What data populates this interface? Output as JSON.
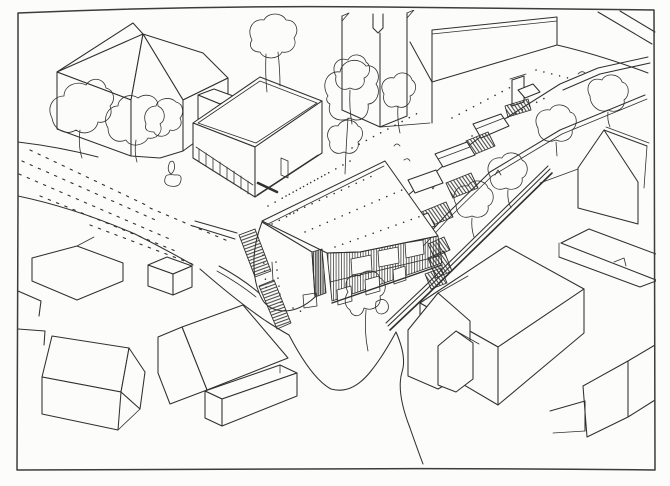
{
  "canvas": {
    "width": 670,
    "height": 486,
    "description": "Hand-drawn black ink architectural site sketch, aerial axonometric view of a village centre: a proposed timber-clad community building with a large mono-pitch roof sits at the junction of two streets, reached by terraced landscaped steps beside a church tower and churchyard wall; surrounding gabled houses, a flat-roofed hall, trees and roads frame the scene inside a hand-drawn border."
  },
  "css_vars": {
    "--paper": "#fcfcfa",
    "--ink": "#303030",
    "--border-ink": "#3c3c3c"
  },
  "scene": {
    "style": "freehand pen line drawing, no colour fill",
    "elements": [
      {
        "name": "border-frame",
        "description": "hand-drawn rectangular frame around the sketch"
      },
      {
        "name": "top-left-house",
        "description": "large cross-gabled house at upper left"
      },
      {
        "name": "village-hall",
        "description": "flat-roofed square hall with colonnade base"
      },
      {
        "name": "church-tower",
        "description": "church tower with corner pinnacles, cropped by frame"
      },
      {
        "name": "churchyard-wall",
        "description": "long coped wall beside the tower"
      },
      {
        "name": "terraced-steps",
        "description": "landscaped stepped path with planters and stair flights"
      },
      {
        "name": "proposed-building",
        "description": "new building with stippled roof, vertical timber slat facade, glazing, curved rendered corner wall and entrance stairs"
      },
      {
        "name": "gabled-houses",
        "description": "clusters of simple gabled houses lower left, lower right and right edge"
      },
      {
        "name": "trees",
        "description": "loose blob-outline trees with trunks"
      },
      {
        "name": "roads",
        "description": "textured road at upper left, stippled street, curving lanes at bottom"
      }
    ]
  }
}
